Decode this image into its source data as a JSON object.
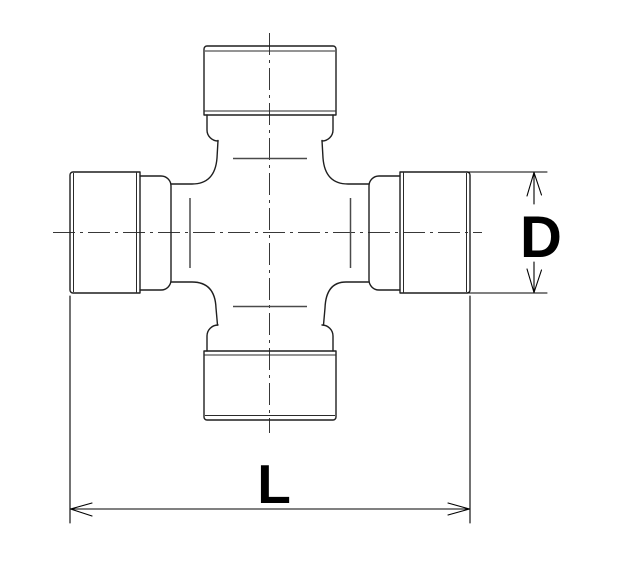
{
  "drawing": {
    "subject": "universal-joint-cross-spider",
    "view": "front-outline-technical-drawing",
    "colors": {
      "background": "#ffffff",
      "outline": "#1f1f1f",
      "surface_marks": "#4a4a4a",
      "centerline": "#383838",
      "dimension": "#000000"
    },
    "dimensions": {
      "diameter_label": "D",
      "length_label": "L"
    }
  }
}
